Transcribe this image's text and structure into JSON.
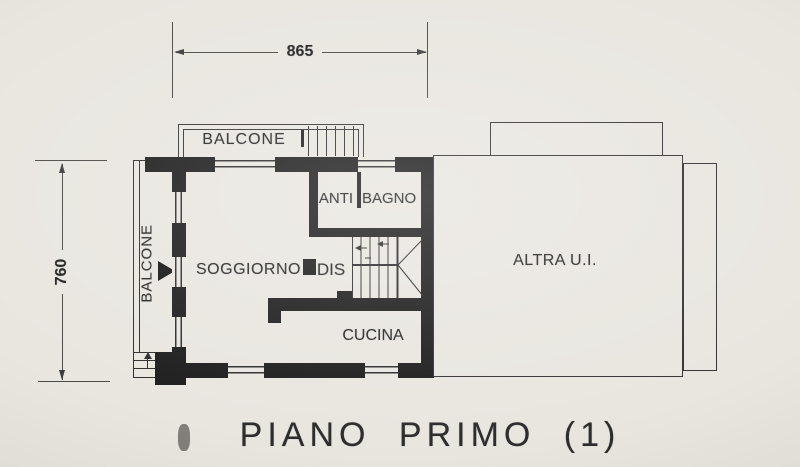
{
  "drawing": {
    "title": "PIANO PRIMO (1)",
    "dim_top": "865",
    "dim_left": "760",
    "rooms": {
      "balcone_top": "BALCONE",
      "balcone_left": "BALCONE",
      "anti": "ANTI",
      "bagno": "BAGNO",
      "soggiorno": "SOGGIORNO",
      "dis": "DIS",
      "cucina": "CUCINA",
      "altra_ui": "ALTRA  U.I."
    },
    "colors": {
      "paper": "#e9e6e0",
      "wall_ink": "#1c1c1c",
      "line_ink": "#2e2e2e"
    }
  }
}
